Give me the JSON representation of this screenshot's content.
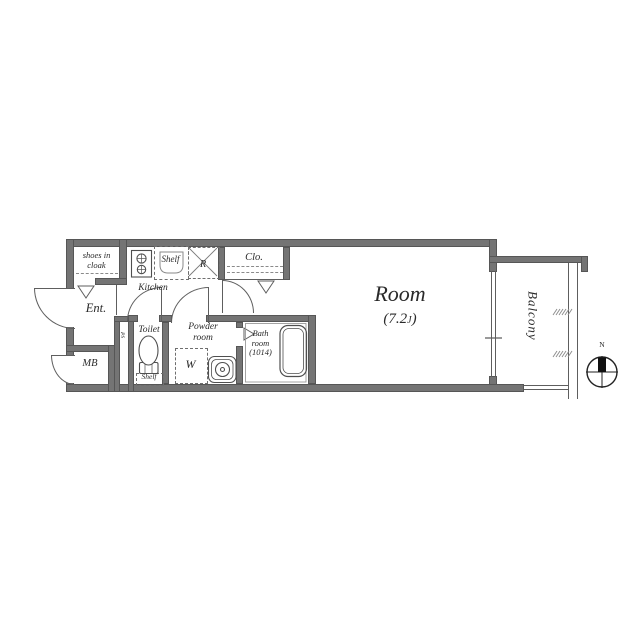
{
  "plan": {
    "rooms": {
      "shoes_cloak": {
        "label_line1": "shoes in",
        "label_line2": "cloak"
      },
      "kitchen": {
        "label": "Kitchen",
        "shelf_label": "Shelf",
        "fridge_label": "R"
      },
      "closet": {
        "label": "Clo."
      },
      "entrance": {
        "label": "Ent."
      },
      "meter_box": {
        "label": "MB"
      },
      "pipe_space": {
        "label": "PS"
      },
      "toilet": {
        "label": "Toilet",
        "shelf_label": "Shelf"
      },
      "powder_room": {
        "label_line1": "Powder",
        "label_line2": "room",
        "washer_label": "W"
      },
      "bath_room": {
        "label_line1": "Bath",
        "label_line2": "room",
        "label_line3": "(1014)"
      },
      "main_room": {
        "label": "Room",
        "area_prefix": "(7.2",
        "area_unit": "J",
        "area_suffix": ")"
      },
      "balcony": {
        "label": "Balcony"
      }
    },
    "compass": {
      "north_label": "N"
    },
    "colors": {
      "wall": "#747474",
      "line": "#5e5e5e",
      "text": "#2a2a2a",
      "background": "#ffffff"
    }
  }
}
